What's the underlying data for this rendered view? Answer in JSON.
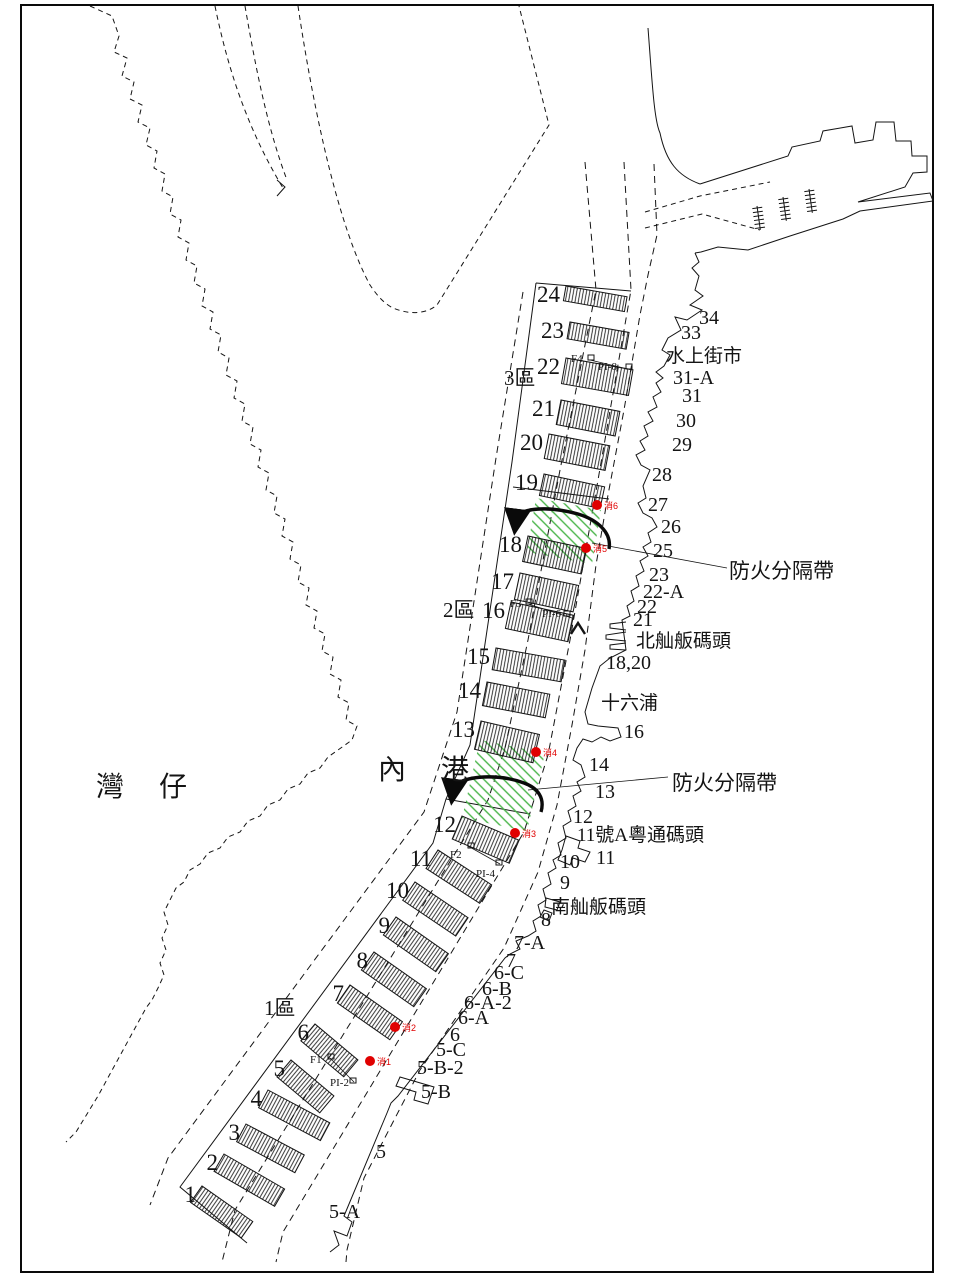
{
  "map_region": {
    "sea_labels": [
      {
        "text": "灣  仔",
        "x": 96,
        "y": 796
      },
      {
        "text": "內  港",
        "x": 378,
        "y": 779
      }
    ],
    "zone_labels": [
      {
        "text": "3區",
        "x": 504,
        "y": 385
      },
      {
        "text": "2區",
        "x": 443,
        "y": 617
      },
      {
        "text": "1區",
        "x": 264,
        "y": 1015
      }
    ],
    "firebreak_labels": [
      {
        "text": "防火分隔帶",
        "x": 729,
        "y": 578
      },
      {
        "text": "防火分隔帶",
        "x": 672,
        "y": 790
      }
    ],
    "colors": {
      "line": "#141414",
      "firebreak_green": "#4ab54a",
      "hydrant_red": "#e00000"
    }
  },
  "piers": [
    {
      "n": "24",
      "x": 566,
      "y": 286,
      "len": 62,
      "h": 15,
      "a": 10
    },
    {
      "n": "23",
      "x": 570,
      "y": 322,
      "len": 60,
      "h": 17,
      "a": 10
    },
    {
      "n": "22",
      "x": 566,
      "y": 358,
      "len": 68,
      "h": 26,
      "a": 10
    },
    {
      "n": "21",
      "x": 561,
      "y": 400,
      "len": 60,
      "h": 25,
      "a": 11
    },
    {
      "n": "20",
      "x": 549,
      "y": 434,
      "len": 62,
      "h": 25,
      "a": 11
    },
    {
      "n": "19",
      "x": 544,
      "y": 474,
      "len": 62,
      "h": 22,
      "a": 12
    },
    {
      "n": "18",
      "x": 528,
      "y": 536,
      "len": 60,
      "h": 26,
      "a": 12
    },
    {
      "n": "17",
      "x": 520,
      "y": 573,
      "len": 60,
      "h": 27,
      "a": 12
    },
    {
      "n": "16",
      "x": 511,
      "y": 602,
      "len": 64,
      "h": 27,
      "a": 12
    },
    {
      "n": "15",
      "x": 496,
      "y": 648,
      "len": 70,
      "h": 22,
      "a": 10
    },
    {
      "n": "14",
      "x": 487,
      "y": 682,
      "len": 64,
      "h": 24,
      "a": 11
    },
    {
      "n": "13",
      "x": 481,
      "y": 721,
      "len": 60,
      "h": 29,
      "a": 13
    },
    {
      "n": "12",
      "x": 462,
      "y": 816,
      "len": 62,
      "h": 25,
      "a": 23
    },
    {
      "n": "11",
      "x": 438,
      "y": 850,
      "len": 64,
      "h": 22,
      "a": 33
    },
    {
      "n": "10",
      "x": 415,
      "y": 882,
      "len": 64,
      "h": 22,
      "a": 34
    },
    {
      "n": "9",
      "x": 396,
      "y": 917,
      "len": 64,
      "h": 22,
      "a": 35
    },
    {
      "n": "8",
      "x": 374,
      "y": 952,
      "len": 64,
      "h": 22,
      "a": 35
    },
    {
      "n": "7",
      "x": 350,
      "y": 985,
      "len": 64,
      "h": 22,
      "a": 35
    },
    {
      "n": "6",
      "x": 315,
      "y": 1024,
      "len": 56,
      "h": 22,
      "a": 40
    },
    {
      "n": "5",
      "x": 291,
      "y": 1060,
      "len": 56,
      "h": 22,
      "a": 40
    },
    {
      "n": "4",
      "x": 268,
      "y": 1090,
      "len": 70,
      "h": 20,
      "a": 28
    },
    {
      "n": "3",
      "x": 246,
      "y": 1124,
      "len": 66,
      "h": 20,
      "a": 28
    },
    {
      "n": "2",
      "x": 224,
      "y": 1154,
      "len": 70,
      "h": 20,
      "a": 30
    },
    {
      "n": "1",
      "x": 202,
      "y": 1186,
      "len": 62,
      "h": 20,
      "a": 35
    }
  ],
  "shore_labels": [
    {
      "text": "34",
      "x": 699,
      "y": 324,
      "cjk": false
    },
    {
      "text": "33",
      "x": 681,
      "y": 339,
      "cjk": false
    },
    {
      "text": "水上街市",
      "x": 666,
      "y": 362,
      "cjk": true
    },
    {
      "text": "31-A",
      "x": 673,
      "y": 384,
      "cjk": false
    },
    {
      "text": "31",
      "x": 682,
      "y": 402,
      "cjk": false
    },
    {
      "text": "30",
      "x": 676,
      "y": 427,
      "cjk": false
    },
    {
      "text": "29",
      "x": 672,
      "y": 451,
      "cjk": false
    },
    {
      "text": "28",
      "x": 652,
      "y": 481,
      "cjk": false
    },
    {
      "text": "27",
      "x": 648,
      "y": 511,
      "cjk": false
    },
    {
      "text": "26",
      "x": 661,
      "y": 533,
      "cjk": false
    },
    {
      "text": "25",
      "x": 653,
      "y": 557,
      "cjk": false
    },
    {
      "text": "23",
      "x": 649,
      "y": 581,
      "cjk": false
    },
    {
      "text": "22-A",
      "x": 643,
      "y": 598,
      "cjk": false
    },
    {
      "text": "22",
      "x": 637,
      "y": 613,
      "cjk": false
    },
    {
      "text": "21",
      "x": 633,
      "y": 626,
      "cjk": false
    },
    {
      "text": "北舢舨碼頭",
      "x": 636,
      "y": 647,
      "cjk": true
    },
    {
      "text": "18,20",
      "x": 606,
      "y": 669,
      "cjk": false
    },
    {
      "text": "十六浦",
      "x": 601,
      "y": 709,
      "cjk": true
    },
    {
      "text": "16",
      "x": 624,
      "y": 738,
      "cjk": false
    },
    {
      "text": "14",
      "x": 589,
      "y": 771,
      "cjk": false
    },
    {
      "text": "13",
      "x": 595,
      "y": 798,
      "cjk": false
    },
    {
      "text": "12",
      "x": 573,
      "y": 823,
      "cjk": false
    },
    {
      "text": "11號A粵通碼頭",
      "x": 577,
      "y": 841,
      "cjk": true
    },
    {
      "text": "11",
      "x": 596,
      "y": 864,
      "cjk": false
    },
    {
      "text": "10",
      "x": 560,
      "y": 868,
      "cjk": false
    },
    {
      "text": "9",
      "x": 560,
      "y": 889,
      "cjk": false
    },
    {
      "text": "南舢舨碼頭",
      "x": 551,
      "y": 913,
      "cjk": true
    },
    {
      "text": "8",
      "x": 541,
      "y": 926,
      "cjk": false
    },
    {
      "text": "7-A",
      "x": 514,
      "y": 949,
      "cjk": false
    },
    {
      "text": "7",
      "x": 506,
      "y": 967,
      "cjk": false
    },
    {
      "text": "6-C",
      "x": 494,
      "y": 979,
      "cjk": false
    },
    {
      "text": "6-B",
      "x": 482,
      "y": 995,
      "cjk": false
    },
    {
      "text": "6-A-2",
      "x": 464,
      "y": 1009,
      "cjk": false
    },
    {
      "text": "6-A",
      "x": 458,
      "y": 1024,
      "cjk": false
    },
    {
      "text": "6",
      "x": 450,
      "y": 1041,
      "cjk": false
    },
    {
      "text": "5-C",
      "x": 436,
      "y": 1056,
      "cjk": false
    },
    {
      "text": "5-B-2",
      "x": 417,
      "y": 1074,
      "cjk": false
    },
    {
      "text": "5-B",
      "x": 421,
      "y": 1098,
      "cjk": false
    },
    {
      "text": "5",
      "x": 376,
      "y": 1158,
      "cjk": false
    },
    {
      "text": "5-A",
      "x": 329,
      "y": 1218,
      "cjk": false
    }
  ],
  "hydrants": [
    {
      "label": "消1",
      "x": 370,
      "y": 1061
    },
    {
      "label": "消2",
      "x": 395,
      "y": 1027
    },
    {
      "label": "消3",
      "x": 515,
      "y": 833
    },
    {
      "label": "消4",
      "x": 536,
      "y": 752
    },
    {
      "label": "消5",
      "x": 586,
      "y": 548
    },
    {
      "label": "消6",
      "x": 597,
      "y": 505
    }
  ],
  "facility_labels": [
    {
      "text": "F4",
      "x": 571,
      "y": 362
    },
    {
      "text": "PI-8",
      "x": 598,
      "y": 370
    },
    {
      "text": "F3",
      "x": 510,
      "y": 607
    },
    {
      "text": "PI-6",
      "x": 542,
      "y": 617
    },
    {
      "text": "F2",
      "x": 450,
      "y": 858
    },
    {
      "text": "PI-4",
      "x": 476,
      "y": 877
    },
    {
      "text": "F1",
      "x": 310,
      "y": 1063
    },
    {
      "text": "PI-2",
      "x": 330,
      "y": 1086
    }
  ],
  "valve_icons": [
    {
      "x": 588,
      "y": 355
    },
    {
      "x": 626,
      "y": 364
    },
    {
      "x": 526,
      "y": 599
    },
    {
      "x": 564,
      "y": 611
    },
    {
      "x": 468,
      "y": 843
    },
    {
      "x": 496,
      "y": 860
    },
    {
      "x": 328,
      "y": 1054
    },
    {
      "x": 350,
      "y": 1078
    }
  ],
  "stairs_icons": [
    {
      "x": 757,
      "y": 206
    },
    {
      "x": 783,
      "y": 197
    },
    {
      "x": 809,
      "y": 189
    }
  ]
}
